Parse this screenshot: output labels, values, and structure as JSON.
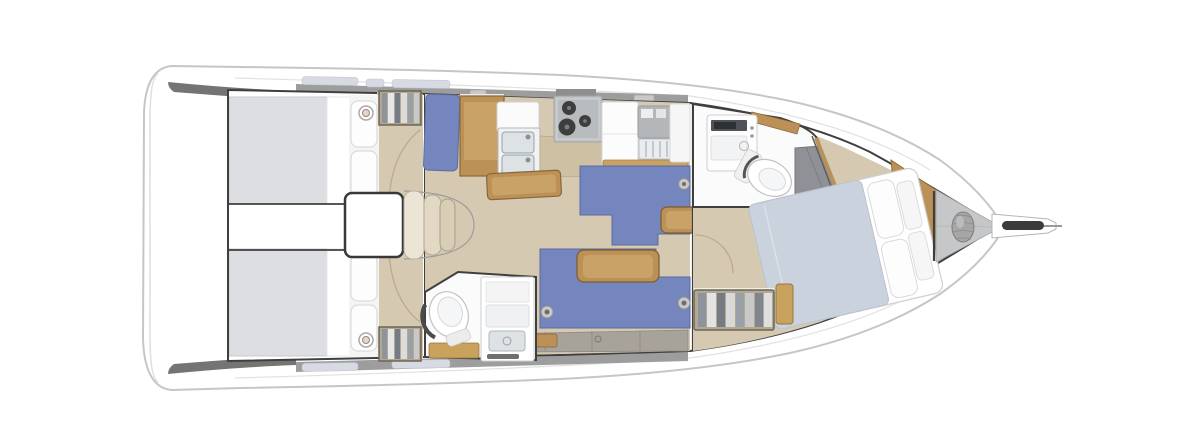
{
  "meta": {
    "kind": "sailboat-interior-floorplan",
    "orientation": "bow-right"
  },
  "palette": {
    "bg": "#ffffff",
    "hullWhite": "#ffffff",
    "hullOutline": "#c6c6c6",
    "innerLine": "#dedede",
    "cornerGray": "#747474",
    "deckGray": "#9d9d9d",
    "windowGlaze": "#d8dae3",
    "hatchGray": "#c9c9c9",
    "bulkhead": "#3f3f3f",
    "floor": "#d6c9b2",
    "berth": "#dcdee1",
    "sheetWhite": "#ffffff",
    "pillow": "#fdfdfd",
    "settee": "#7486bd",
    "setteeDark": "#5a6b9e",
    "wood": "#bb9157",
    "woodDark": "#8a6634",
    "woodLight": "#c9a267",
    "counterWhite": "#fbfbfb",
    "steel": "#dde2e5",
    "stoveGray": "#c0c3c5",
    "burner": "#3e3e3e",
    "showerGray": "#8f9196",
    "bandGray": "#a7a29a",
    "lockerGray": "#c6c7c9",
    "duvet": "#c9d2dd",
    "wardrobe": "#b4a88f",
    "tanFloor": "#c9a25d",
    "windlass": "#a6a6a6",
    "roller": "#3b3b3b",
    "toiletWhite": "#ffffff",
    "headFloor": "#fbfbfb",
    "engineBox": "#ffffff"
  }
}
